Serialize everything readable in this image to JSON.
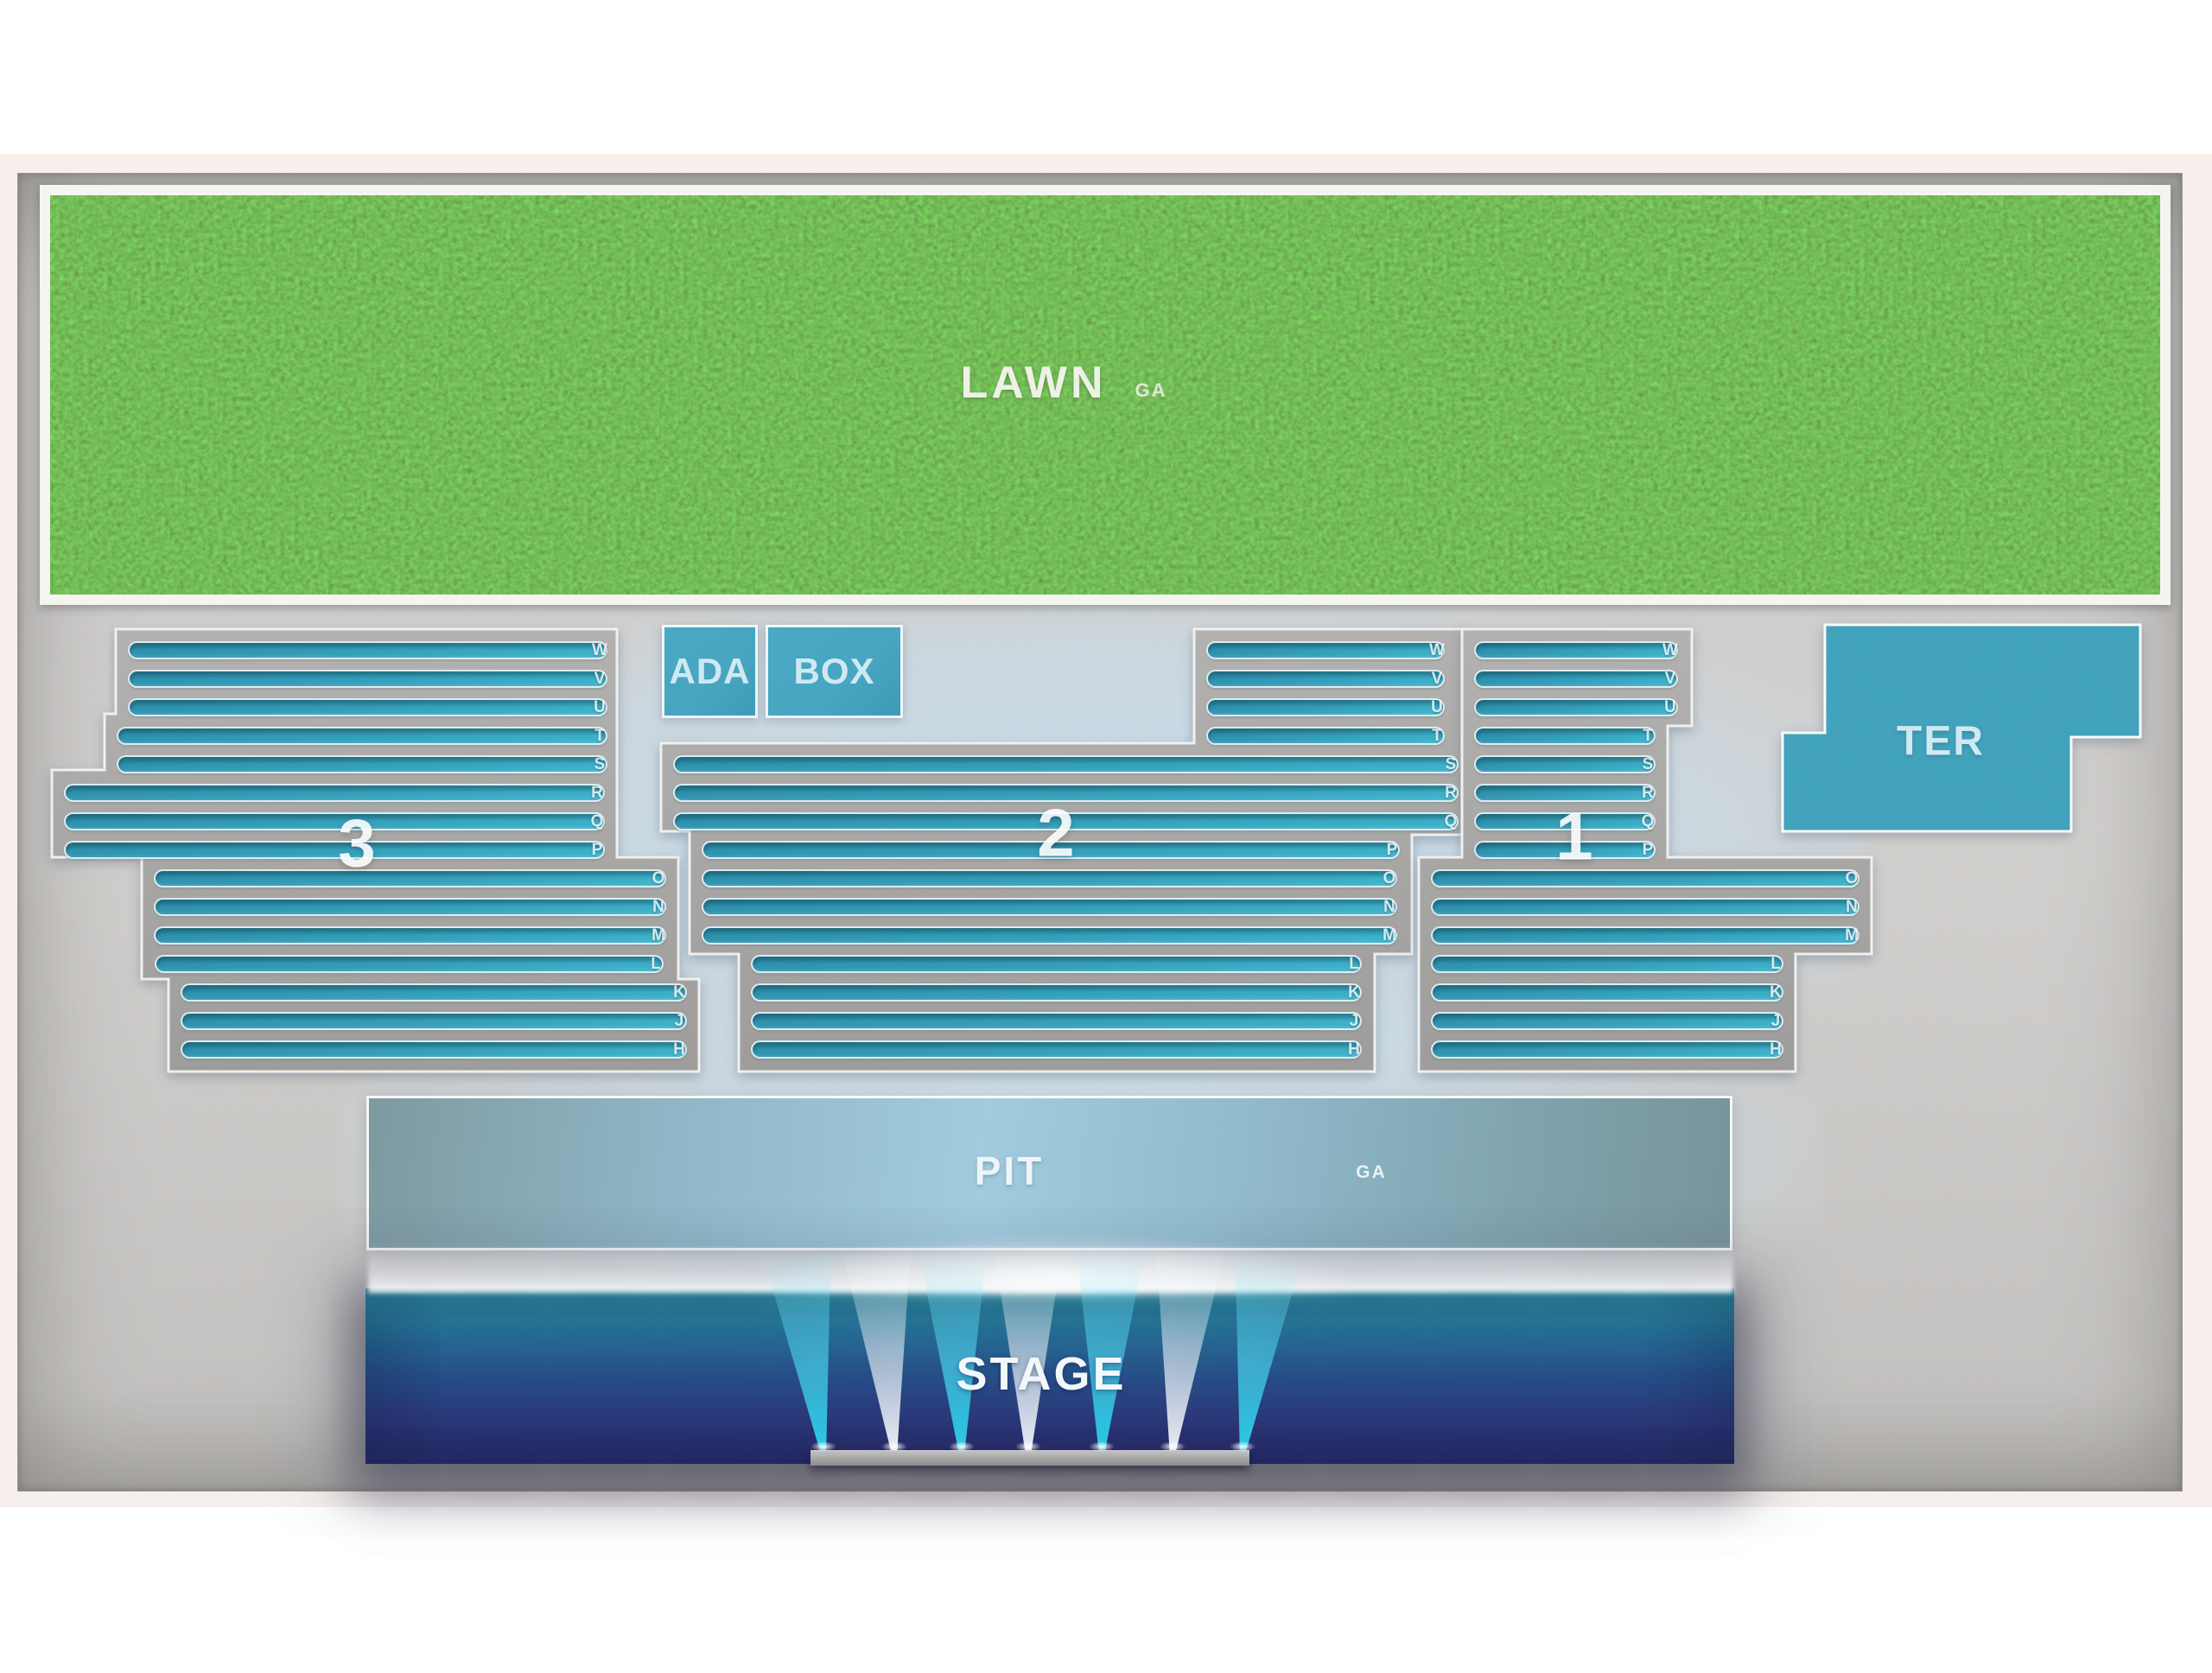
{
  "venue_map": {
    "lawn": {
      "label": "LAWN",
      "ga": "GA"
    },
    "boxes": {
      "ada": "ADA",
      "box": "BOX",
      "terrace": "TER"
    },
    "pit": {
      "label": "PIT",
      "ga": "GA"
    },
    "stage": {
      "label": "STAGE"
    },
    "sections": [
      {
        "label": "3",
        "rows": [
          "W",
          "V",
          "U",
          "T",
          "S",
          "R",
          "Q",
          "P",
          "O",
          "N",
          "M",
          "L",
          "K",
          "J",
          "H"
        ]
      },
      {
        "label": "2",
        "rows": [
          "W",
          "V",
          "U",
          "T",
          "S",
          "R",
          "Q",
          "P",
          "O",
          "N",
          "M",
          "L",
          "K",
          "J",
          "H"
        ]
      },
      {
        "label": "1",
        "rows": [
          "W",
          "V",
          "U",
          "T",
          "S",
          "R",
          "Q",
          "P",
          "O",
          "N",
          "M",
          "L",
          "K",
          "J",
          "H"
        ]
      }
    ],
    "colors": {
      "background": "#ffffff",
      "mat_pink": "#f6efec",
      "panel_gray": "#cbc9c7",
      "slab_gray": "#a9a8a6",
      "seat_teal": "#2e93af",
      "seat_teal_light": "#3db2cb",
      "area_teal": "#47a5c1",
      "area_label": "#cfe9f2",
      "lawn_green": "#4c7a31",
      "pit_light": "#a2cbde",
      "stage_teal": "#2e93a8",
      "stage_navy": "#2b2e6d",
      "beam_cyan": "#35d6f0"
    }
  }
}
